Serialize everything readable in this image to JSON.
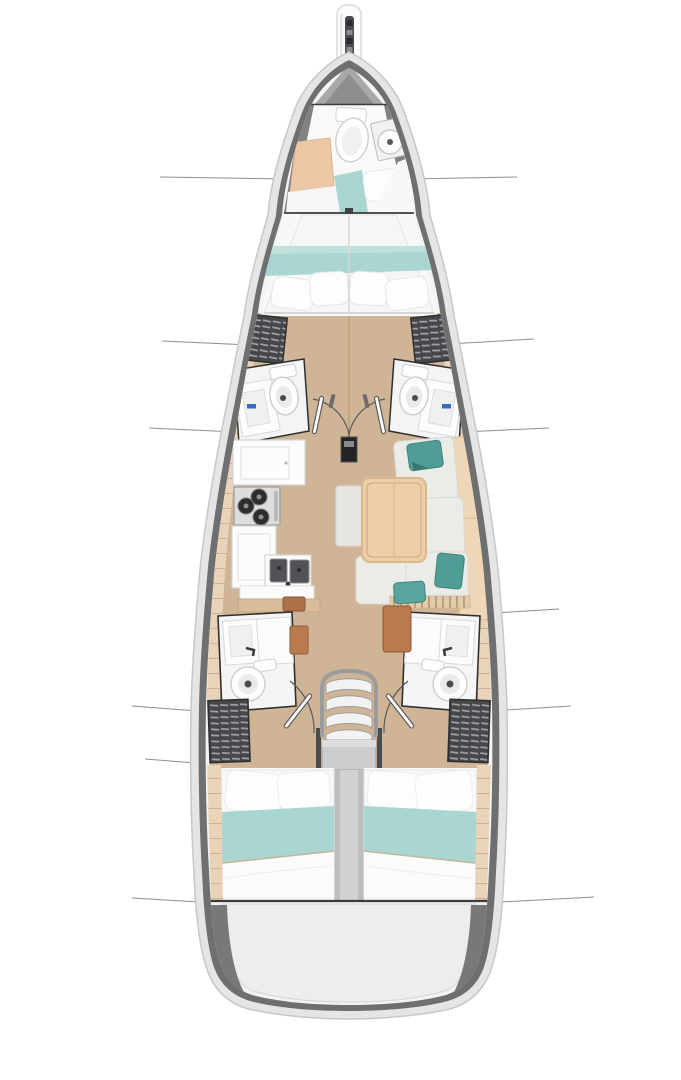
{
  "figure": {
    "kind": "sailboat-deck-plan-top-view",
    "orientation": "bow-up",
    "visible_text": ""
  },
  "counts": {
    "double_berths": 3,
    "bow_berth": 1,
    "toilets": 5,
    "companionway_steps": 4,
    "louver_lockers": 4,
    "salon_teal_pillows": 3
  },
  "colors": {
    "background": "#ffffff",
    "hull_outer": "#e4e5e7",
    "hull_rim_stroke": "#c6c7c9",
    "hull_band": "#6e6f71",
    "hull_inner": "#f3f3f4",
    "forepeak_gray": "#a7a8aa",
    "wood_floor": "#cfb595",
    "floor_seam": "#b99b79",
    "side_plank": "#e9d4b9",
    "plank_line": "#cfb28d",
    "cabin_white": "#f8f8f9",
    "bed_white": "#fdfdfe",
    "teal_blanket": "#a9d6d1",
    "teal_pillow": "#4f9d95",
    "cushion_tan": "#ebc7a5",
    "sofa_cushion": "#ebebe8",
    "backrest_tan": "#eed6b6",
    "table_wood": "#eccfa9",
    "table_edge": "#d9b98c",
    "rug": "#e7e7e2",
    "counter_white": "#fcfcfd",
    "counter_edge": "#d4d5d7",
    "stove_steel": "#dcdddf",
    "burner_dark": "#2c2d2f",
    "sink_steel": "#515255",
    "fixture_outline": "#cfd0d2",
    "wall_dark": "#2e2f31",
    "louver_dark": "#46474a",
    "louver_slat": "#9fa0a3",
    "cabinet_brown": "#b97a50",
    "center_gray": "#bcbdbf",
    "stair_metal": "#9a9b9d",
    "landing_gray": "#cccdcf",
    "transom_floor": "#ededee",
    "transom_wedge": "#77787a",
    "section_line": "#8e8f90",
    "faucet_blue": "#3a6bc4",
    "mast_black": "#232425",
    "anchor_dark": "#4a4b4e",
    "bulkhead_dark": "#3a3b3c"
  },
  "section_lines": [
    {
      "x1": 160,
      "y1": 177,
      "x2": 290,
      "y2": 179
    },
    {
      "x1": 408,
      "y1": 179,
      "x2": 517,
      "y2": 177
    },
    {
      "x1": 162,
      "y1": 341,
      "x2": 250,
      "y2": 345
    },
    {
      "x1": 448,
      "y1": 344,
      "x2": 534,
      "y2": 339
    },
    {
      "x1": 149,
      "y1": 428,
      "x2": 236,
      "y2": 432
    },
    {
      "x1": 462,
      "y1": 432,
      "x2": 549,
      "y2": 428
    },
    {
      "x1": 494,
      "y1": 613,
      "x2": 559,
      "y2": 609
    },
    {
      "x1": 132,
      "y1": 706,
      "x2": 210,
      "y2": 712
    },
    {
      "x1": 490,
      "y1": 711,
      "x2": 571,
      "y2": 706
    },
    {
      "x1": 145,
      "y1": 759,
      "x2": 208,
      "y2": 764
    },
    {
      "x1": 132,
      "y1": 898,
      "x2": 216,
      "y2": 903
    },
    {
      "x1": 482,
      "y1": 903,
      "x2": 594,
      "y2": 897
    }
  ]
}
